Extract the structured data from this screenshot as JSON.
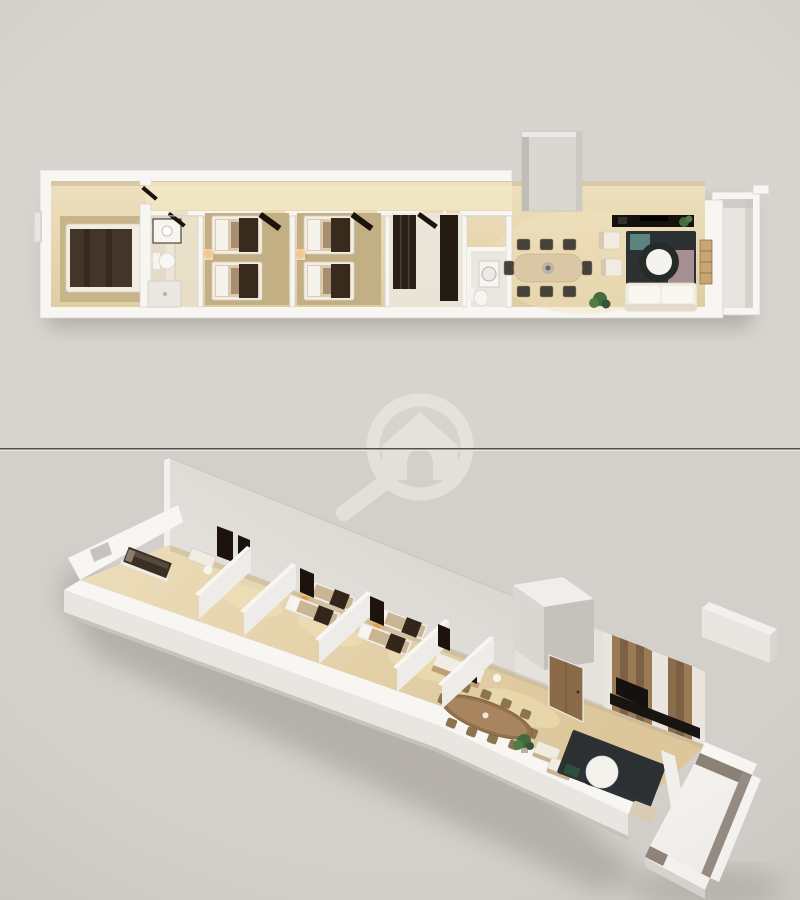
{
  "meta": {
    "image_type": "3d-floor-plan-render",
    "width_px": 800,
    "height_px": 900,
    "visible_text": []
  },
  "layout": {
    "divider_y_px": 449,
    "panels": [
      "top-down-plan-view",
      "isometric-dollhouse-view"
    ]
  },
  "watermark": {
    "icon": "magnifier-house-logo",
    "opacity": 0.68
  },
  "palette": {
    "bg_top": "#d7d3ce",
    "bg_bottom": "#d3cfca",
    "divider_dark": "#56514c",
    "divider_light": "#eae7e3",
    "wall_white": "#f7f6f3",
    "wall_face": "#e9e6e2",
    "wall_shade": "#d9d5d0",
    "wall_dark": "#c6c2bd",
    "floor_wood": "#e9dab6",
    "floor_wood_deep": "#dcc99f",
    "corridor_glow": "#f3e7c7",
    "rug_tan": "#c7b489",
    "bed_blanket": "#43352a",
    "bed_runner": "#382b1e",
    "pillow": "#d5c4af",
    "linen_tan": "#c9b593",
    "lamp_glow": "#e8963f",
    "dark_panel": "#1b130c",
    "chair_dark": "#45423c",
    "table_wood_light": "#dbc8a6",
    "table_wood_dark": "#93714d",
    "sofa_cream": "#f1ece1",
    "rug_dark": "#262b2f",
    "throw_mauve": "#b39a9c",
    "throw_teal": "#5f8f86",
    "plant_green": "#436b3c",
    "wood_panel_light": "#9a7a55",
    "wood_panel_dark": "#7b6044",
    "marble": "#eae6df",
    "door_wood": "#8a6a48",
    "balcony_inner": "#8b8177",
    "shadow": "#8f8a83",
    "watermark": "#ece9e5"
  },
  "views": [
    {
      "id": "top-plan",
      "projection": "top-down-3d",
      "position": "upper-half",
      "rooms": [
        {
          "name": "master-bedroom",
          "items": [
            "double-bed",
            "dark-blanket",
            "pillows",
            "area-rug",
            "headboard"
          ]
        },
        {
          "name": "bathroom",
          "items": [
            "vanity-sink",
            "toilet",
            "shower",
            "open-dark-door"
          ]
        },
        {
          "name": "bedroom-2",
          "items": [
            "single-bed",
            "single-bed",
            "nightstand",
            "glowing-lamp",
            "open-dark-door"
          ]
        },
        {
          "name": "bedroom-3",
          "items": [
            "single-bed",
            "single-bed",
            "nightstand",
            "glowing-lamp",
            "open-dark-door"
          ]
        },
        {
          "name": "hall-closet",
          "items": [
            "dark-wardrobe",
            "dark-wardrobe"
          ]
        },
        {
          "name": "guest-wc",
          "items": [
            "washing-machine",
            "toilet"
          ]
        },
        {
          "name": "corridor",
          "items": []
        },
        {
          "name": "dining-area",
          "items": [
            "rounded-dining-table",
            "eight-chairs",
            "centerpiece"
          ]
        },
        {
          "name": "living-area",
          "items": [
            "tv-console",
            "armchair",
            "armchair",
            "round-coffee-table",
            "dark-rug",
            "sofa",
            "plant",
            "plant",
            "wall-shelf",
            "mauve-throw",
            "teal-throw"
          ]
        },
        {
          "name": "entry-vestibule",
          "items": [
            "open-dark-door"
          ]
        },
        {
          "name": "utility-block",
          "items": []
        },
        {
          "name": "wall-niche",
          "items": []
        }
      ]
    },
    {
      "id": "iso-view",
      "projection": "isometric-perspective-3d",
      "position": "lower-half",
      "rooms": [
        {
          "name": "master-bedroom",
          "items": [
            "double-bed-dark"
          ]
        },
        {
          "name": "bathroom",
          "items": [
            "vanity",
            "toilet",
            "tall-dark-doors"
          ]
        },
        {
          "name": "bedroom-2",
          "items": [
            "single-bed",
            "single-bed",
            "glowing-lamp"
          ]
        },
        {
          "name": "bedroom-3",
          "items": [
            "single-bed",
            "single-bed",
            "glowing-lamp"
          ]
        },
        {
          "name": "hallway",
          "items": [
            "counter",
            "dark-panel"
          ]
        },
        {
          "name": "guest-wc",
          "items": [
            "toilet"
          ]
        },
        {
          "name": "dining-area",
          "items": [
            "oval-dark-wood-table",
            "chairs",
            "plant"
          ]
        },
        {
          "name": "living-area",
          "items": [
            "cream-armchairs",
            "round-white-table",
            "dark-rug",
            "beige-pouf",
            "tv-wood-panel-wall",
            "tv-screen",
            "tv-console",
            "entrance-door"
          ]
        },
        {
          "name": "balcony",
          "items": []
        },
        {
          "name": "utility-block",
          "items": []
        },
        {
          "name": "tall-back-wall",
          "items": []
        }
      ]
    }
  ]
}
